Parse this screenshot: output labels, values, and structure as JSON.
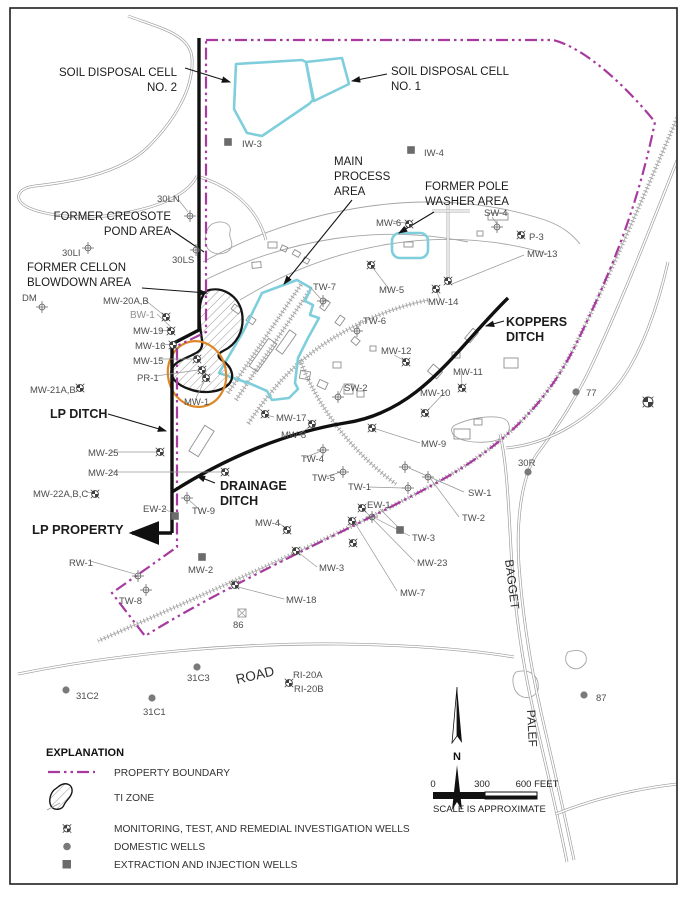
{
  "colors": {
    "boundary": "#A63A9E",
    "cyan": "#7FCEDC",
    "orange": "#DE8728",
    "ditch": "#101010",
    "well_label": "#4d4d4d",
    "light_label": "#8f8f8f",
    "area_label": "#1b1b1b",
    "domestic": "#7a7a7a",
    "injection": "#6b6b6b",
    "symbol": "#3f3f3f"
  },
  "legend": {
    "title": "EXPLANATION",
    "items": [
      {
        "key": "boundary",
        "label": "PROPERTY BOUNDARY"
      },
      {
        "key": "ti",
        "label": "TI ZONE"
      },
      {
        "key": "monitoring",
        "label": "MONITORING, TEST, AND REMEDIAL INVESTIGATION WELLS"
      },
      {
        "key": "domestic",
        "label": "DOMESTIC WELLS"
      },
      {
        "key": "injection",
        "label": "EXTRACTION AND INJECTION WELLS"
      }
    ]
  },
  "north_label": "N",
  "scale": {
    "ticks": [
      "0",
      "300",
      "600 FEET"
    ],
    "note": "SCALE IS APPROXIMATE"
  },
  "road_names": [
    {
      "t": "ROAD",
      "x": 237,
      "y": 684,
      "rot": -13,
      "size": 13.5
    },
    {
      "t": "BAGGET",
      "x": 505,
      "y": 560,
      "rot": 83,
      "size": 12
    },
    {
      "t": "PALEF",
      "x": 527,
      "y": 710,
      "rot": 87,
      "size": 12
    }
  ],
  "area_labels": [
    {
      "lines": [
        "SOIL DISPOSAL CELL",
        "NO. 2"
      ],
      "x": 177,
      "y": 76,
      "anchor": "end",
      "size": 11.5,
      "weight": 400
    },
    {
      "lines": [
        "SOIL DISPOSAL CELL",
        "NO. 1"
      ],
      "x": 391,
      "y": 75,
      "anchor": "start",
      "size": 11.5,
      "weight": 400
    },
    {
      "lines": [
        "MAIN",
        "PROCESS",
        "AREA"
      ],
      "x": 334,
      "y": 165,
      "anchor": "start",
      "size": 11.5,
      "weight": 400
    },
    {
      "lines": [
        "FORMER POLE",
        "WASHER AREA"
      ],
      "x": 425,
      "y": 190,
      "anchor": "start",
      "size": 11.5,
      "weight": 400
    },
    {
      "lines": [
        "FORMER CREOSOTE",
        "POND AREA"
      ],
      "x": 171,
      "y": 220,
      "anchor": "end",
      "size": 11.5,
      "weight": 400
    },
    {
      "lines": [
        "FORMER CELLON",
        "BLOWDOWN AREA"
      ],
      "x": 27,
      "y": 271,
      "anchor": "start",
      "size": 11.5,
      "weight": 400
    },
    {
      "lines": [
        "KOPPERS",
        "DITCH"
      ],
      "x": 506,
      "y": 326,
      "anchor": "start",
      "size": 12.5,
      "weight": 700
    },
    {
      "lines": [
        "LP DITCH"
      ],
      "x": 50,
      "y": 418,
      "anchor": "start",
      "size": 12.5,
      "weight": 700
    },
    {
      "lines": [
        "DRAINAGE",
        "DITCH"
      ],
      "x": 220,
      "y": 490,
      "anchor": "start",
      "size": 12.5,
      "weight": 700
    },
    {
      "lines": [
        "LP PROPERTY"
      ],
      "x": 32,
      "y": 534,
      "anchor": "start",
      "size": 13,
      "weight": 700
    }
  ],
  "well_labels": [
    {
      "t": "IW-3",
      "x": 242,
      "y": 147
    },
    {
      "t": "IW-4",
      "x": 424,
      "y": 156
    },
    {
      "t": "30LN",
      "x": 157,
      "y": 202
    },
    {
      "t": "30LI",
      "x": 62,
      "y": 256
    },
    {
      "t": "30LS",
      "x": 172,
      "y": 263
    },
    {
      "t": "DM",
      "x": 22,
      "y": 301
    },
    {
      "t": "MW-20A,B",
      "x": 103,
      "y": 304
    },
    {
      "t": "BW-1",
      "x": 130,
      "y": 318,
      "light": true
    },
    {
      "t": "MW-19",
      "x": 133,
      "y": 334
    },
    {
      "t": "MW-16",
      "x": 135,
      "y": 349
    },
    {
      "t": "MW-15",
      "x": 133,
      "y": 364
    },
    {
      "t": "PR-1",
      "x": 137,
      "y": 381
    },
    {
      "t": "MW-21A,B",
      "x": 30,
      "y": 393
    },
    {
      "t": "MW-1",
      "x": 184,
      "y": 405
    },
    {
      "t": "MW-17",
      "x": 276,
      "y": 421
    },
    {
      "t": "MW-8",
      "x": 281,
      "y": 438
    },
    {
      "t": "TW-7",
      "x": 313,
      "y": 290
    },
    {
      "t": "TW-6",
      "x": 363,
      "y": 324
    },
    {
      "t": "MW-5",
      "x": 379,
      "y": 293
    },
    {
      "t": "MW-14",
      "x": 428,
      "y": 305
    },
    {
      "t": "MW-12",
      "x": 381,
      "y": 354
    },
    {
      "t": "MW-11",
      "x": 453,
      "y": 375
    },
    {
      "t": "MW-10",
      "x": 420,
      "y": 396
    },
    {
      "t": "SW-2",
      "x": 344,
      "y": 391
    },
    {
      "t": "MW-9",
      "x": 421,
      "y": 447
    },
    {
      "t": "MW-13",
      "x": 527,
      "y": 257
    },
    {
      "t": "SW-4",
      "x": 484,
      "y": 216
    },
    {
      "t": "P-3",
      "x": 529,
      "y": 240
    },
    {
      "t": "MW-6",
      "x": 376,
      "y": 226
    },
    {
      "t": "77",
      "x": 586,
      "y": 396
    },
    {
      "t": "30R",
      "x": 518,
      "y": 466
    },
    {
      "t": "SW-1",
      "x": 468,
      "y": 496
    },
    {
      "t": "TW-2",
      "x": 462,
      "y": 521
    },
    {
      "t": "TW-4",
      "x": 301,
      "y": 462
    },
    {
      "t": "TW-5",
      "x": 312,
      "y": 481
    },
    {
      "t": "TW-1",
      "x": 348,
      "y": 490
    },
    {
      "t": "TW-3",
      "x": 412,
      "y": 541
    },
    {
      "t": "MW-23",
      "x": 417,
      "y": 566
    },
    {
      "t": "MW-7",
      "x": 400,
      "y": 596
    },
    {
      "t": "MW-25",
      "x": 88,
      "y": 456
    },
    {
      "t": "MW-24",
      "x": 88,
      "y": 476
    },
    {
      "t": "MW-22A,B,C",
      "x": 33,
      "y": 497
    },
    {
      "t": "EW-2",
      "x": 143,
      "y": 512
    },
    {
      "t": "TW-9",
      "x": 192,
      "y": 514
    },
    {
      "t": "MW-4",
      "x": 255,
      "y": 526
    },
    {
      "t": "EW-1",
      "x": 367,
      "y": 508
    },
    {
      "t": "MW-2",
      "x": 188,
      "y": 573
    },
    {
      "t": "MW-3",
      "x": 319,
      "y": 571
    },
    {
      "t": "MW-18",
      "x": 286,
      "y": 603
    },
    {
      "t": "86",
      "x": 233,
      "y": 628
    },
    {
      "t": "RW-1",
      "x": 69,
      "y": 566
    },
    {
      "t": "TW-8",
      "x": 119,
      "y": 604
    },
    {
      "t": "31C2",
      "x": 76,
      "y": 699
    },
    {
      "t": "31C1",
      "x": 143,
      "y": 715
    },
    {
      "t": "31C3",
      "x": 187,
      "y": 681
    },
    {
      "t": "RI-20A",
      "x": 293,
      "y": 678
    },
    {
      "t": "RI-20B",
      "x": 294,
      "y": 692
    },
    {
      "t": "87",
      "x": 596,
      "y": 701
    }
  ],
  "wells": {
    "quad": [
      [
        166,
        317
      ],
      [
        171,
        331
      ],
      [
        173,
        345
      ],
      [
        197,
        359
      ],
      [
        202,
        370
      ],
      [
        206,
        378
      ],
      [
        80,
        388
      ],
      [
        265,
        414
      ],
      [
        312,
        424
      ],
      [
        409,
        224
      ],
      [
        371,
        265
      ],
      [
        436,
        289
      ],
      [
        448,
        281
      ],
      [
        521,
        235
      ],
      [
        406,
        362
      ],
      [
        462,
        388
      ],
      [
        425,
        413
      ],
      [
        372,
        428
      ],
      [
        362,
        508
      ],
      [
        352,
        521
      ],
      [
        296,
        551
      ],
      [
        287,
        530
      ],
      [
        235,
        585
      ],
      [
        160,
        452
      ],
      [
        225,
        472
      ],
      [
        95,
        494
      ],
      [
        289,
        683
      ],
      [
        353,
        543
      ],
      [
        648,
        402,
        5
      ]
    ],
    "cross": [
      [
        190,
        216
      ],
      [
        88,
        248
      ],
      [
        196,
        250
      ],
      [
        42,
        307
      ],
      [
        323,
        301
      ],
      [
        357,
        331
      ],
      [
        497,
        227
      ],
      [
        338,
        397
      ],
      [
        323,
        450
      ],
      [
        343,
        472
      ],
      [
        408,
        488
      ],
      [
        405,
        467
      ],
      [
        428,
        477
      ],
      [
        187,
        498
      ],
      [
        138,
        576
      ],
      [
        146,
        590
      ],
      [
        372,
        517
      ]
    ],
    "domestic": [
      [
        66,
        690
      ],
      [
        152,
        698
      ],
      [
        197,
        667
      ],
      [
        528,
        472
      ],
      [
        576,
        392
      ],
      [
        584,
        695
      ]
    ],
    "square": [
      [
        228,
        142
      ],
      [
        411,
        150
      ],
      [
        202,
        557
      ],
      [
        400,
        530
      ],
      [
        175,
        516
      ]
    ],
    "crossed_square": [
      [
        242,
        613
      ]
    ]
  },
  "geometry": {
    "boundary": "M206,40 L553,40 C585,48 625,85 655,122 C640,195 618,258 578,340 C545,410 495,452 427,488 C347,531 230,583 145,636 L112,593 L177,547 L177,346 L206,332 Z",
    "ditches": [
      "M199,38 L199,330 L172,344 L172,533",
      "M172,492 C230,455 290,432 345,423 C420,412 455,350 508,298"
    ],
    "lp_arrow": [
      172,
      533,
      132,
      533
    ],
    "black_arrows": [
      [
        185,
        68,
        230,
        82
      ],
      [
        387,
        74,
        352,
        81
      ],
      [
        352,
        200,
        284,
        284
      ],
      [
        434,
        212,
        399,
        233
      ],
      [
        142,
        288,
        207,
        293
      ],
      [
        504,
        321,
        486,
        326
      ],
      [
        108,
        414,
        166,
        431
      ],
      [
        215,
        483,
        197,
        476
      ]
    ],
    "black_lines": [
      [
        170,
        229,
        204,
        252
      ]
    ],
    "roads": [
      "M128,16 C160,28 190,34 192,58 C194,88 175,120 148,147 C118,176 62,183 35,186 C18,188 14,198 24,205 C36,214 80,222 125,213 C162,206 188,194 197,176",
      "M197,176 C235,188 258,210 266,240",
      "M18,674 C120,653 240,643 340,644 C420,645 472,650 514,657",
      "M694,118 C664,192 632,278 596,356 C577,398 558,426 540,450 C521,473 516,522 519,566 C523,620 531,668 541,712 C550,752 562,802 574,860",
      "M500,434 C508,468 509,520 512,566 C516,620 524,670 534,714 C543,754 555,802 567,862",
      "M506,448 C550,444 592,418 620,382 C642,352 658,306 668,262",
      "M556,814 C600,796 652,786 688,783",
      "M448,204 L448,280",
      "M432,211 L470,211"
    ],
    "thin_lines": [
      "M203,262 C300,208 430,182 545,220 C562,226 572,234 580,244",
      "M240,300 C330,245 440,222 548,254",
      "M205,280 C290,238 380,224 468,242",
      "M568,652 C580,648 588,652 586,662 C580,672 570,670 566,662 C565,658 566,654 568,652 Z",
      "M516,672 C530,668 540,676 538,690 C534,700 520,700 515,690 C512,682 512,676 516,672 Z",
      "M455,425 C470,418 490,415 502,418 C510,420 512,430 505,436 C495,444 470,444 458,438 C450,434 450,428 455,425 Z"
    ],
    "rails": [
      "M687,95 C655,170 616,262 577,342 C543,412 493,453 425,489 C345,532 226,585 98,641",
      "M428,300 C390,308 345,326 305,358 C285,374 265,398 248,424",
      "M236,400 L310,290",
      "M228,393 L302,283",
      "M300,360 C318,408 352,452 396,484"
    ],
    "cyan": [
      "M236,64 L302,60 L306,62 L313,100 L309,104 L262,136 L247,133 L234,109 Z",
      "M306,62 L342,58 L349,84 L314,101 Z",
      "M297,280 L311,288 L305,301 L313,305 L310,315 L319,318 L308,338 L298,358 L295,383 L298,389 L289,398 L272,400 L267,391 L251,384 L219,373 L243,332 L262,293 Z",
      "M400,233 h20 a8,8 0 0 1 8,8 v9 a8,8 0 0 1 -8,8 h-20 a8,8 0 0 1 -8,-8 v-9 a8,8 0 0 1 8,-8 Z"
    ],
    "ti_zone": "M206,291 C222,285 239,296 242,313 C245,331 236,345 223,351 C217,354 217,357 223,361 C232,367 235,377 229,384 C220,393 202,394 189,389 C177,385 169,377 172,369 C175,361 185,359 194,354 C201,351 203,347 202,340 C199,321 197,301 206,291 Z",
    "pond": "M212,224 C223,219 232,224 230,232 C228,238 234,241 231,248 C227,255 214,256 208,249 C203,242 205,229 212,224 Z",
    "orange": {
      "cx": 197,
      "cy": 374,
      "rx": 29,
      "ry": 33,
      "rot": -12
    },
    "buildings": [
      [
        268,
        242,
        9,
        6,
        0
      ],
      [
        281,
        246,
        6,
        5,
        25
      ],
      [
        293,
        251,
        7,
        5,
        30
      ],
      [
        303,
        258,
        6,
        5,
        30
      ],
      [
        252,
        262,
        9,
        6,
        -5
      ],
      [
        232,
        306,
        9,
        6,
        35
      ],
      [
        247,
        317,
        8,
        6,
        35
      ],
      [
        258,
        338,
        10,
        34,
        35
      ],
      [
        282,
        330,
        8,
        24,
        35
      ],
      [
        300,
        371,
        10,
        8,
        10
      ],
      [
        318,
        381,
        9,
        7,
        25
      ],
      [
        333,
        362,
        8,
        6,
        0
      ],
      [
        344,
        384,
        9,
        10,
        0
      ],
      [
        357,
        391,
        7,
        6,
        0
      ],
      [
        429,
        367,
        12,
        9,
        40
      ],
      [
        452,
        352,
        8,
        6,
        0
      ],
      [
        468,
        329,
        7,
        13,
        40
      ],
      [
        488,
        213,
        20,
        7,
        0
      ],
      [
        477,
        231,
        6,
        5,
        0
      ],
      [
        404,
        242,
        9,
        5,
        0
      ],
      [
        196,
        426,
        11,
        30,
        32
      ],
      [
        454,
        429,
        16,
        10,
        0
      ],
      [
        474,
        419,
        8,
        6,
        0
      ],
      [
        504,
        358,
        14,
        10,
        0
      ],
      [
        352,
        338,
        7,
        6,
        40
      ],
      [
        370,
        346,
        6,
        5,
        0
      ],
      [
        322,
        300,
        6,
        10,
        35
      ],
      [
        337,
        316,
        6,
        9,
        35
      ]
    ],
    "leaders": [
      [
        145,
        300,
        165,
        316
      ],
      [
        157,
        314,
        172,
        328
      ],
      [
        160,
        330,
        170,
        331
      ],
      [
        162,
        344,
        172,
        345
      ],
      [
        160,
        359,
        193,
        359
      ],
      [
        156,
        376,
        198,
        370
      ],
      [
        195,
        400,
        205,
        380
      ],
      [
        274,
        417,
        266,
        415
      ],
      [
        299,
        434,
        311,
        426
      ],
      [
        524,
        255,
        452,
        284
      ],
      [
        389,
        289,
        373,
        268
      ],
      [
        440,
        300,
        437,
        292
      ],
      [
        394,
        355,
        405,
        361
      ],
      [
        461,
        371,
        462,
        385
      ],
      [
        446,
        391,
        428,
        410
      ],
      [
        420,
        443,
        376,
        429
      ],
      [
        464,
        492,
        409,
        468
      ],
      [
        459,
        517,
        430,
        478
      ],
      [
        368,
        487,
        404,
        488
      ],
      [
        410,
        536,
        375,
        518
      ],
      [
        415,
        562,
        365,
        511
      ],
      [
        397,
        591,
        355,
        523
      ],
      [
        317,
        567,
        299,
        553
      ],
      [
        284,
        599,
        238,
        587
      ],
      [
        277,
        522,
        286,
        528
      ],
      [
        380,
        509,
        398,
        527
      ],
      [
        110,
        452,
        157,
        452
      ],
      [
        110,
        472,
        221,
        472
      ],
      [
        163,
        508,
        174,
        514
      ],
      [
        90,
        561,
        135,
        574
      ],
      [
        492,
        217,
        497,
        224
      ],
      [
        393,
        221,
        405,
        223
      ],
      [
        310,
        287,
        321,
        299
      ],
      [
        361,
        320,
        358,
        329
      ],
      [
        304,
        458,
        321,
        451
      ],
      [
        325,
        477,
        341,
        472
      ],
      [
        200,
        510,
        189,
        500
      ],
      [
        86,
        492,
        93,
        493
      ],
      [
        178,
        199,
        188,
        212
      ],
      [
        343,
        386,
        339,
        395
      ]
    ]
  }
}
